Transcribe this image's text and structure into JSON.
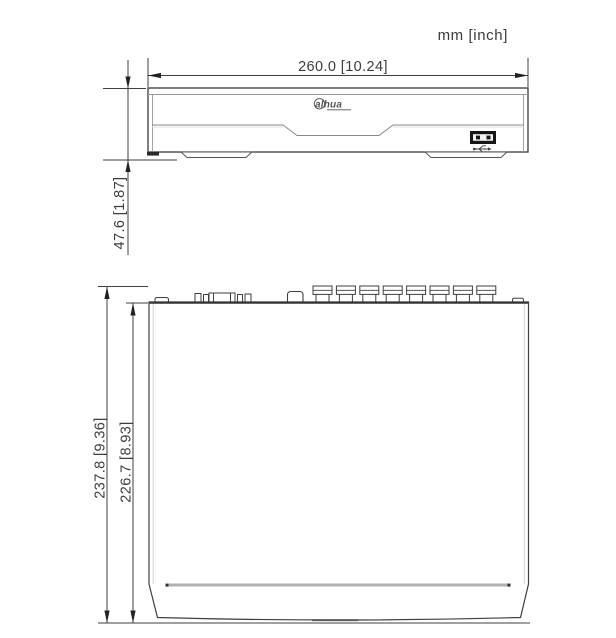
{
  "drawing": {
    "units_label": "mm [inch]",
    "brand_logo": "alhua",
    "front_view": {
      "width_label": "260.0 [10.24]",
      "height_label": "47.6 [1.87]"
    },
    "top_view": {
      "depth_outer_label": "237.8 [9.36]",
      "depth_inner_label": "226.7 [8.93]",
      "bnc_connector_count": 8
    },
    "colors": {
      "line": "#3a3a3a",
      "light_line": "#999999",
      "text": "#3c3c3c",
      "dark_fill": "#161616",
      "background": "#ffffff"
    }
  }
}
